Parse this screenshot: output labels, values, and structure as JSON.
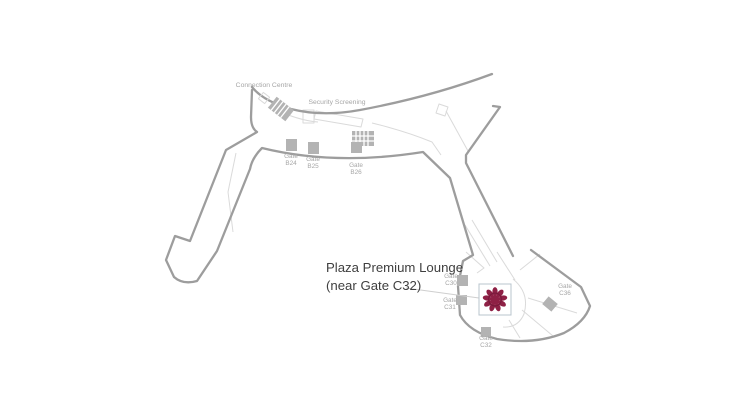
{
  "page": {
    "background": "#ffffff",
    "kind": "airport-terminal-map"
  },
  "colors": {
    "accent_maroon": "#8e2045",
    "accent_maroon_dark": "#73193a",
    "map_outline": "#9d9d9d",
    "map_detail": "#dadada",
    "gate_fill": "#b3b3b3",
    "label_gray": "#a6a6a6",
    "title_text": "#3f3f3f",
    "logo_border": "#b8c4ce"
  },
  "map": {
    "area_labels": {
      "connection_centre": "Connection Centre",
      "security_screening": "Security Screening"
    },
    "lounge": {
      "title_line1": "Plaza Premium Lounge",
      "title_line2": "(near Gate C32)",
      "marker": "plaza-premium-flower-logo"
    },
    "gates": [
      {
        "id": "B24",
        "line1": "Gate",
        "line2": "B24"
      },
      {
        "id": "B25",
        "line1": "Gate",
        "line2": "B25"
      },
      {
        "id": "B26",
        "line1": "Gate",
        "line2": "B26"
      },
      {
        "id": "C30",
        "line1": "Gate",
        "line2": "C30"
      },
      {
        "id": "C31",
        "line1": "Gate",
        "line2": "C31"
      },
      {
        "id": "C36",
        "line1": "Gate",
        "line2": "C36"
      },
      {
        "id": "C32",
        "line1": "Gate",
        "line2": "C32"
      }
    ]
  }
}
